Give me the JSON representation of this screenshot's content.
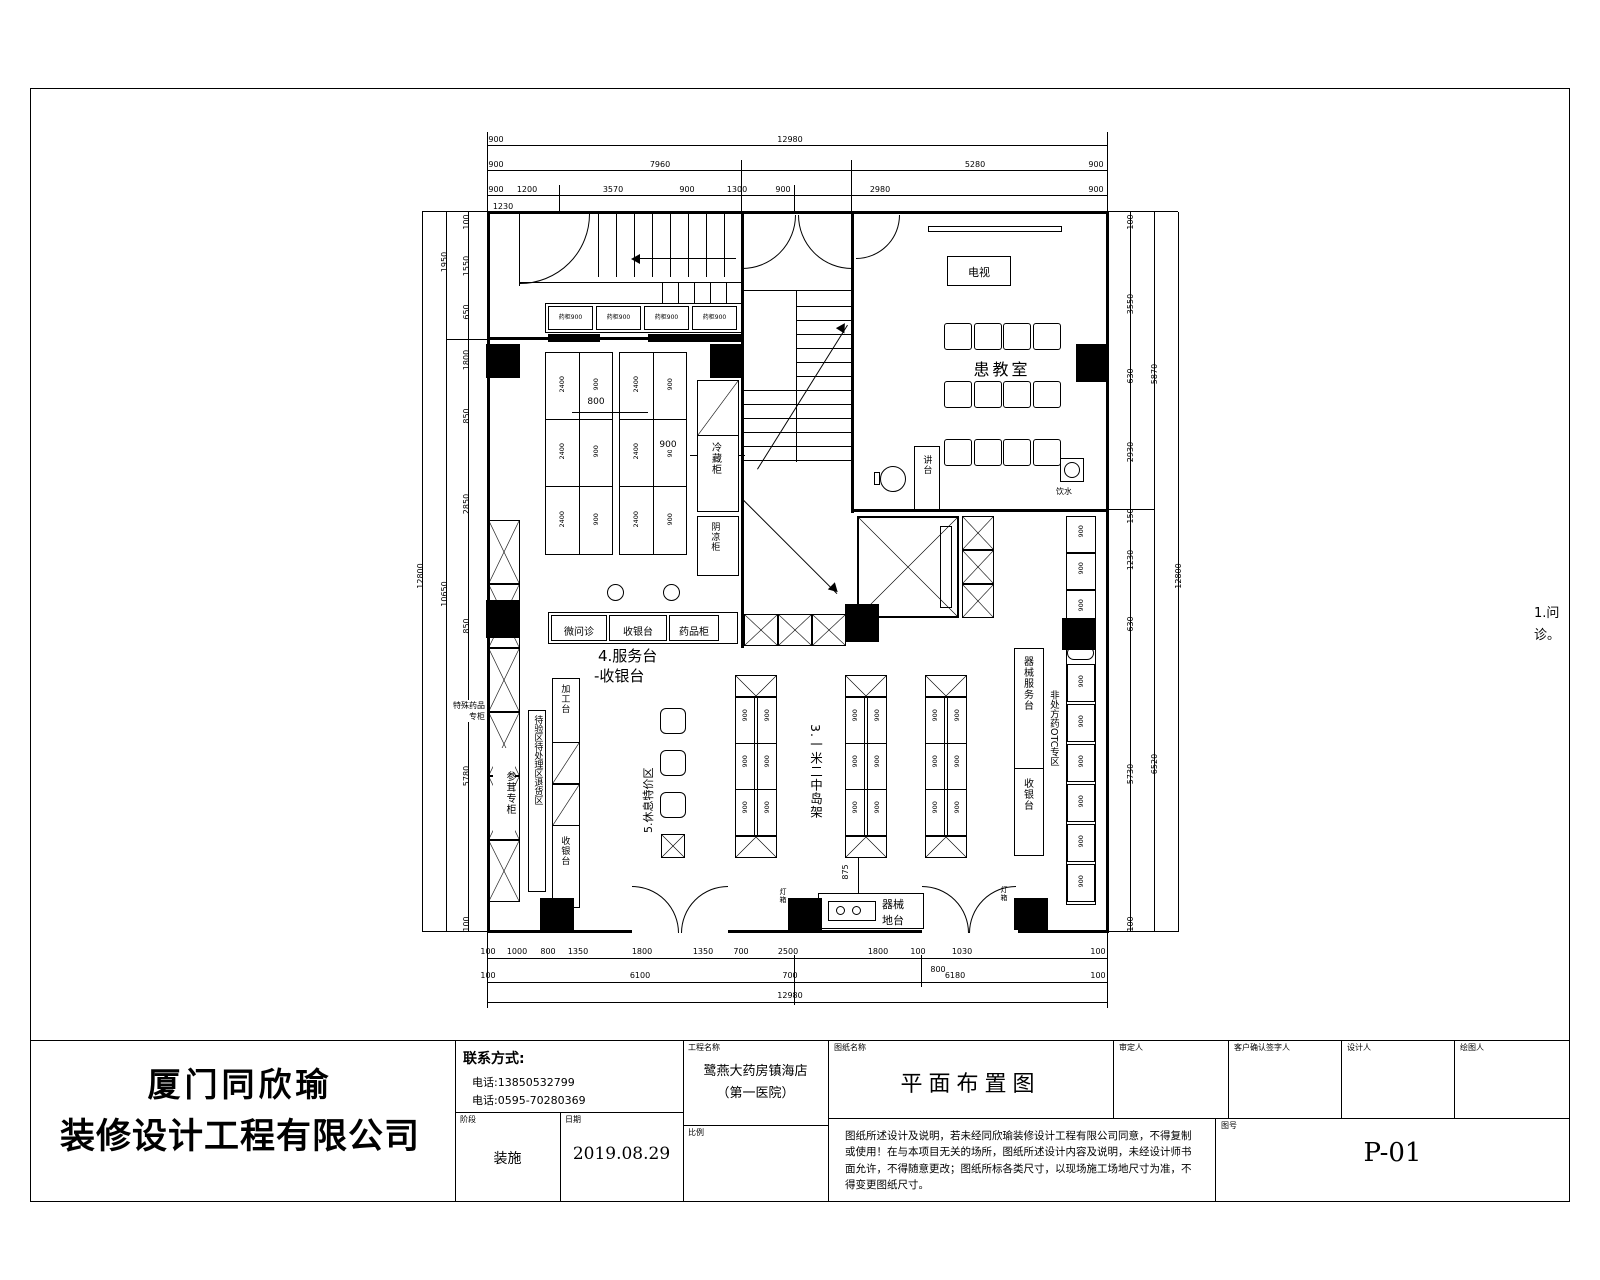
{
  "title_block": {
    "company_line1": "厦门同欣瑜",
    "company_line2": "装修设计工程有限公司",
    "contact_label": "联系方式:",
    "phone1": "电话:13850532799",
    "phone2": "电话:0595-70280369",
    "stage_label": "阶段",
    "stage_value": "装施",
    "date_label": "日期",
    "date_value": "2019.08.29",
    "project_label": "工程名称",
    "project_line1": "鹭燕大药房镇海店",
    "project_line2": "（第一医院）",
    "scale_label": "比例",
    "drawing_name_label": "图纸名称",
    "drawing_name": "平面布置图",
    "approver_label": "审定人",
    "client_sign_label": "客户确认签字人",
    "designer_label": "设计人",
    "drafter_label": "绘图人",
    "drawing_no_label": "图号",
    "drawing_no": "P-01",
    "disclaimer": "图纸所述设计及说明，若未经同欣瑜装修设计工程有限公司同意，不得复制或使用！在与本项目无关的场所，图纸所述设计内容及说明，未经设计师书面允许，不得随意更改；图纸所标各类尺寸，以现场施工场地尺寸为准，不得变更图纸尺寸。"
  },
  "plan": {
    "room": "患教室",
    "tv": "电视",
    "lectern": "讲台",
    "water": "饮水",
    "cabinet": "药柜900",
    "shelf_l": "2400",
    "shelf_r": "900",
    "cold": "冷藏柜",
    "cool": "阴凉柜",
    "counter_cell1": "微问诊",
    "counter_cell2": "收银台",
    "counter_cell3": "药品柜",
    "service_line1": "4.服务台",
    "service_line2": "-收银台",
    "island_label": "3.一米二中岛架",
    "rest_label": "5.休息特价区",
    "proc_top": "加工台",
    "proc_bottom": "收银台",
    "qc_strip": "待验区待处理区退货区",
    "wall_note1": "特殊药品",
    "wall_note2": "专柜",
    "ginseng": "参茸专柜",
    "equip_counter1": "器械服务台",
    "equip_counter2": "收银台",
    "otc_strip": "非处方药OTC专区",
    "platform1": "器械",
    "platform2": "地台",
    "lamp": "灯箱",
    "note_r1": "1.问",
    "note_r2": "诊。"
  },
  "dims": {
    "d800": "800",
    "d900": "900",
    "d875": "875",
    "t1": [
      "900",
      "12980"
    ],
    "t2": [
      "900",
      "7960",
      "5280",
      "900"
    ],
    "t3": [
      "900",
      "1200",
      "3570",
      "900",
      "1300",
      "900",
      "2980",
      "900"
    ],
    "t3b": "1230",
    "b1": [
      "100",
      "1000",
      "800",
      "1350",
      "1800",
      "1350",
      "700",
      "2500",
      "1800",
      "100",
      "1030",
      "100"
    ],
    "b1b": "800",
    "b2": [
      "100",
      "6100",
      "700",
      "6180",
      "100"
    ],
    "b3": "12980",
    "li": [
      "100",
      "1550",
      "650",
      "1800",
      "850",
      "2850",
      "850",
      "5780",
      "100"
    ],
    "lm": [
      "1950",
      "10650"
    ],
    "lo": "12800",
    "ri": [
      "100",
      "3550",
      "630",
      "2930",
      "150",
      "1230",
      "630",
      "5730",
      "100"
    ],
    "rm": [
      "5870",
      "6520"
    ],
    "ro": "12800"
  }
}
